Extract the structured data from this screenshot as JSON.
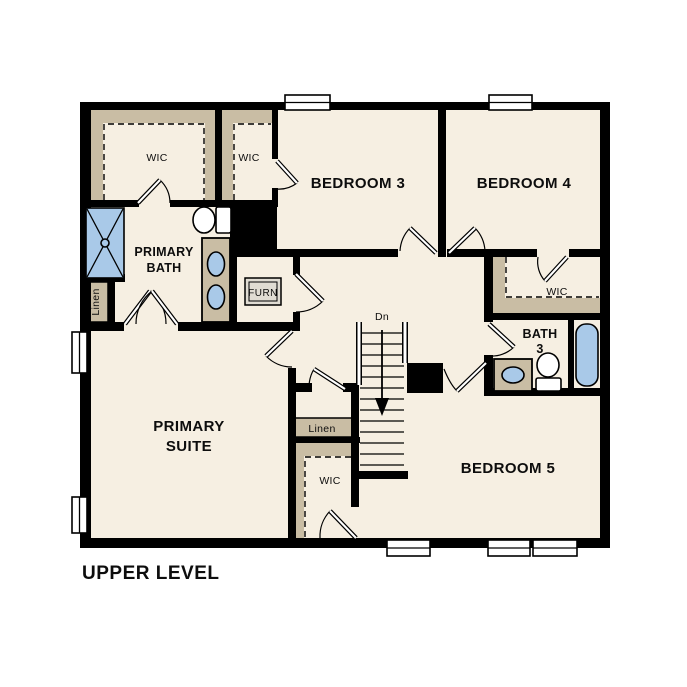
{
  "title": "UPPER LEVEL",
  "rooms": {
    "bedroom3": {
      "label": "BEDROOM 3"
    },
    "bedroom4": {
      "label": "BEDROOM 4"
    },
    "bedroom5": {
      "label": "BEDROOM 5"
    },
    "primary_suite": {
      "line1": "PRIMARY",
      "line2": "SUITE"
    },
    "primary_bath": {
      "line1": "PRIMARY",
      "line2": "BATH"
    },
    "bath3": {
      "line1": "BATH",
      "line2": "3"
    }
  },
  "closets": {
    "wic_primary": {
      "label": "WIC"
    },
    "wic_bedroom3": {
      "label": "WIC"
    },
    "wic_right": {
      "label": "WIC"
    },
    "wic_bedroom5": {
      "label": "WIC"
    },
    "linen_bath": {
      "label": "Linen"
    },
    "linen_hall": {
      "label": "Linen"
    }
  },
  "utility": {
    "furnace": {
      "label": "FURN"
    }
  },
  "stairs": {
    "direction_label": "Dn"
  },
  "colors": {
    "wall": "#000000",
    "floor": "#f6efe2",
    "closet_shelf_tan": "#c9bda4",
    "fixture_blue": "#a9c9e8",
    "furnace_gray": "#e0dcd3",
    "background": "#ffffff"
  }
}
